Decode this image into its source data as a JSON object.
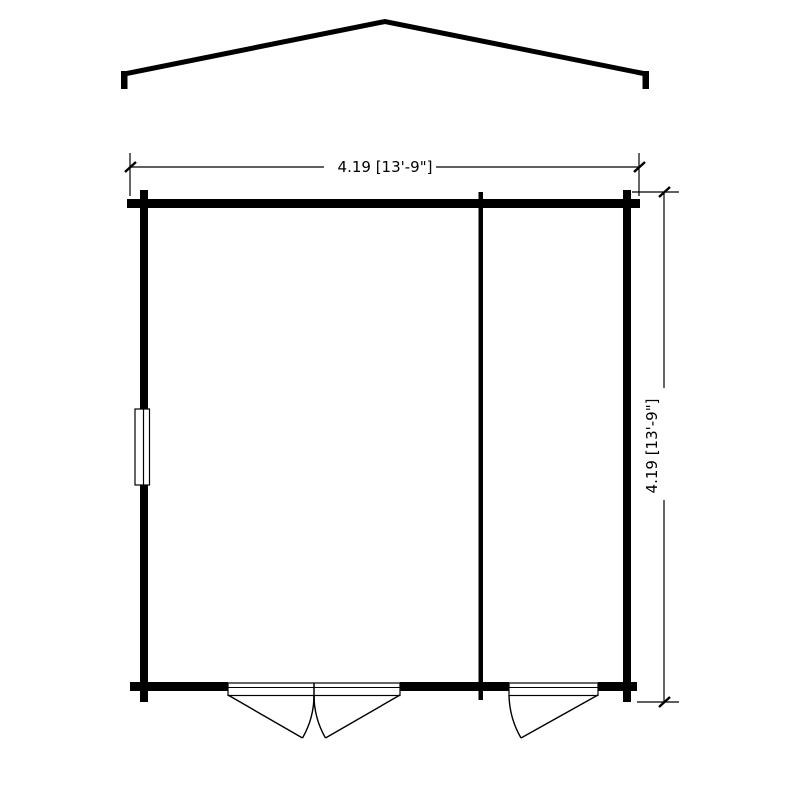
{
  "diagram": {
    "type": "floor-plan",
    "subject": "log-cabin-garden-building-plan",
    "background_color": "#ffffff",
    "line_color": "#000000",
    "dimensions": {
      "width_label": "4.19 [13'-9\"]",
      "depth_label": "4.19 [13'-9\"]",
      "width_meters": "4.19",
      "depth_meters": "4.19",
      "width_imperial": "13'-9\"",
      "height_imperial": "13'-9\""
    },
    "features": {
      "roof": "gable-roof-ridge-outline",
      "window": "left-wall-window",
      "double_door": "double-door-outward-swing",
      "single_door": "single-door-outward-swing",
      "partition": "interior-partition-wall"
    }
  }
}
